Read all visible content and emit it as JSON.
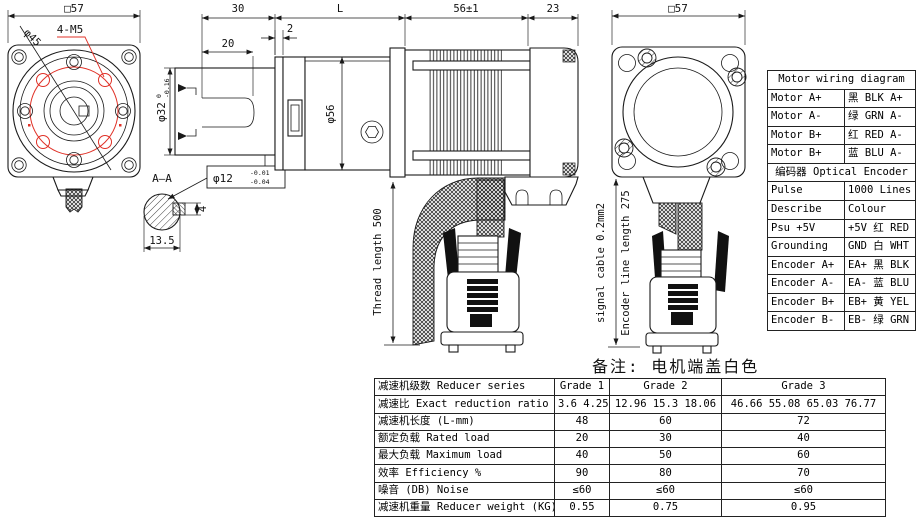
{
  "drawing": {
    "front_view": {
      "dim_width": "□57",
      "label_holes": "4-M5",
      "label_bolt_circle": "φ45"
    },
    "section_aa": {
      "title": "A—A",
      "dim_width": "13.5",
      "dim_key": "4"
    },
    "shaft": {
      "dim_length": "30",
      "dim_keyway": "20",
      "dim_step": "2",
      "dia_base": "φ32",
      "dia_tol_upper": "0",
      "dia_tol_lower": "-0.16",
      "key_dia_base": "φ12",
      "key_dia_tol_upper": "-0.01",
      "key_dia_tol_lower": "-0.04"
    },
    "gearbox": {
      "dim_length": "L",
      "dia": "φ56"
    },
    "motor": {
      "dim_length": "56±1",
      "dim_rear": "23"
    },
    "cables": {
      "thread_length": "Thread length 500",
      "signal_cable": "signal cable 0.2mm2",
      "encoder_length": "Encoder line length 275"
    },
    "rear_view": {
      "dim_width": "□57"
    },
    "note": "备注: 电机端盖白色"
  },
  "wiring_table": {
    "title": "Motor wiring diagram",
    "motor_rows": [
      {
        "label": "Motor A+",
        "value": "黑 BLK A+"
      },
      {
        "label": "Motor A-",
        "value": "绿 GRN A-"
      },
      {
        "label": "Motor B+",
        "value": "红 RED A-"
      },
      {
        "label": "Motor B+",
        "value": "蓝 BLU A-"
      }
    ],
    "encoder_header": "编码器 Optical Encoder",
    "encoder_rows": [
      {
        "label": "Pulse",
        "value": "1000 Lines"
      },
      {
        "label": "Describe",
        "value": "Colour"
      },
      {
        "label": "Psu +5V",
        "value": "+5V 红 RED"
      },
      {
        "label": "Grounding",
        "value": "GND 白 WHT"
      },
      {
        "label": "Encoder A+",
        "value": "EA+ 黑 BLK"
      },
      {
        "label": "Encoder A-",
        "value": "EA- 蓝 BLU"
      },
      {
        "label": "Encoder B+",
        "value": "EB+ 黄 YEL"
      },
      {
        "label": "Encoder B-",
        "value": "EB- 绿 GRN"
      }
    ]
  },
  "spec_table": {
    "header": {
      "label": "减速机级数 Reducer series",
      "cols": [
        "Grade 1",
        "Grade 2",
        "Grade 3"
      ]
    },
    "rows": [
      {
        "label": "减速比 Exact reduction ratio",
        "values": [
          "3.6 4.25",
          "12.96 15.3 18.06",
          "46.66 55.08 65.03 76.77"
        ]
      },
      {
        "label": "减速机长度 (L-mm)",
        "values": [
          "48",
          "60",
          "72"
        ]
      },
      {
        "label": "额定负载 Rated load",
        "values": [
          "20",
          "30",
          "40"
        ]
      },
      {
        "label": "最大负载 Maximum load",
        "values": [
          "40",
          "50",
          "60"
        ]
      },
      {
        "label": "效率 Efficiency %",
        "values": [
          "90",
          "80",
          "70"
        ]
      },
      {
        "label": "噪音 (DB) Noise",
        "values": [
          "≤60",
          "≤60",
          "≤60"
        ]
      },
      {
        "label": "减速机重量 Reducer weight (KG)",
        "values": [
          "0.55",
          "0.75",
          "0.95"
        ]
      }
    ]
  },
  "colors": {
    "line": "#1a1a1a",
    "accent_red": "#e03127"
  }
}
